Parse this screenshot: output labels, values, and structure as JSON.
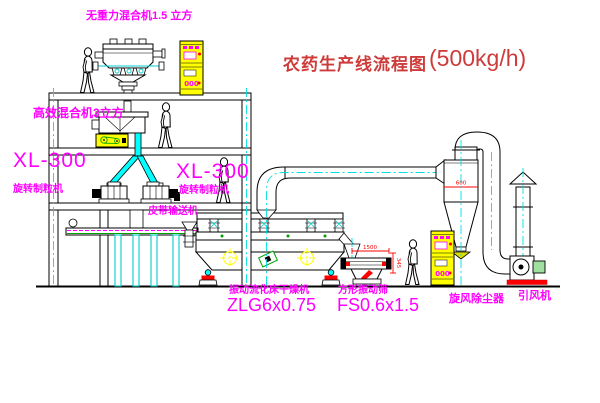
{
  "title": {
    "text_zh": "农药生产线流程图",
    "capacity": "(500kg/h)"
  },
  "equipment_labels": {
    "gravity_mixer": "无重力混合机1.5 立方",
    "high_eff_mixer": "高效混合机3立方",
    "granulator_left": {
      "model": "XL-300",
      "name": "旋转制粒机"
    },
    "granulator_mid": {
      "model": "XL-300",
      "name": "旋转制粒机"
    },
    "belt_conveyor": "皮带输送机",
    "fluid_bed_dryer": {
      "name": "振动流化床干燥机",
      "model": "ZLG6x0.75"
    },
    "square_sieve": {
      "name": "方形振动筛",
      "model": "FS0.6x1.5"
    },
    "cyclone": "旋风除尘器",
    "induced_draft_fan": "引风机"
  },
  "dimensions": {
    "cyclone_outlet": "600",
    "sieve_length": "1500",
    "sieve_height": "345"
  },
  "control_cabinet_display": "000",
  "colors": {
    "label_magenta": "#ff00ff",
    "title_red": "#cd3b3b",
    "centerline_cyan": "#00e0e0",
    "cabinet_yellow": "#ffff00",
    "dimension_red": "#ff0000",
    "belt_green": "#00a000",
    "line_black": "#000000"
  }
}
